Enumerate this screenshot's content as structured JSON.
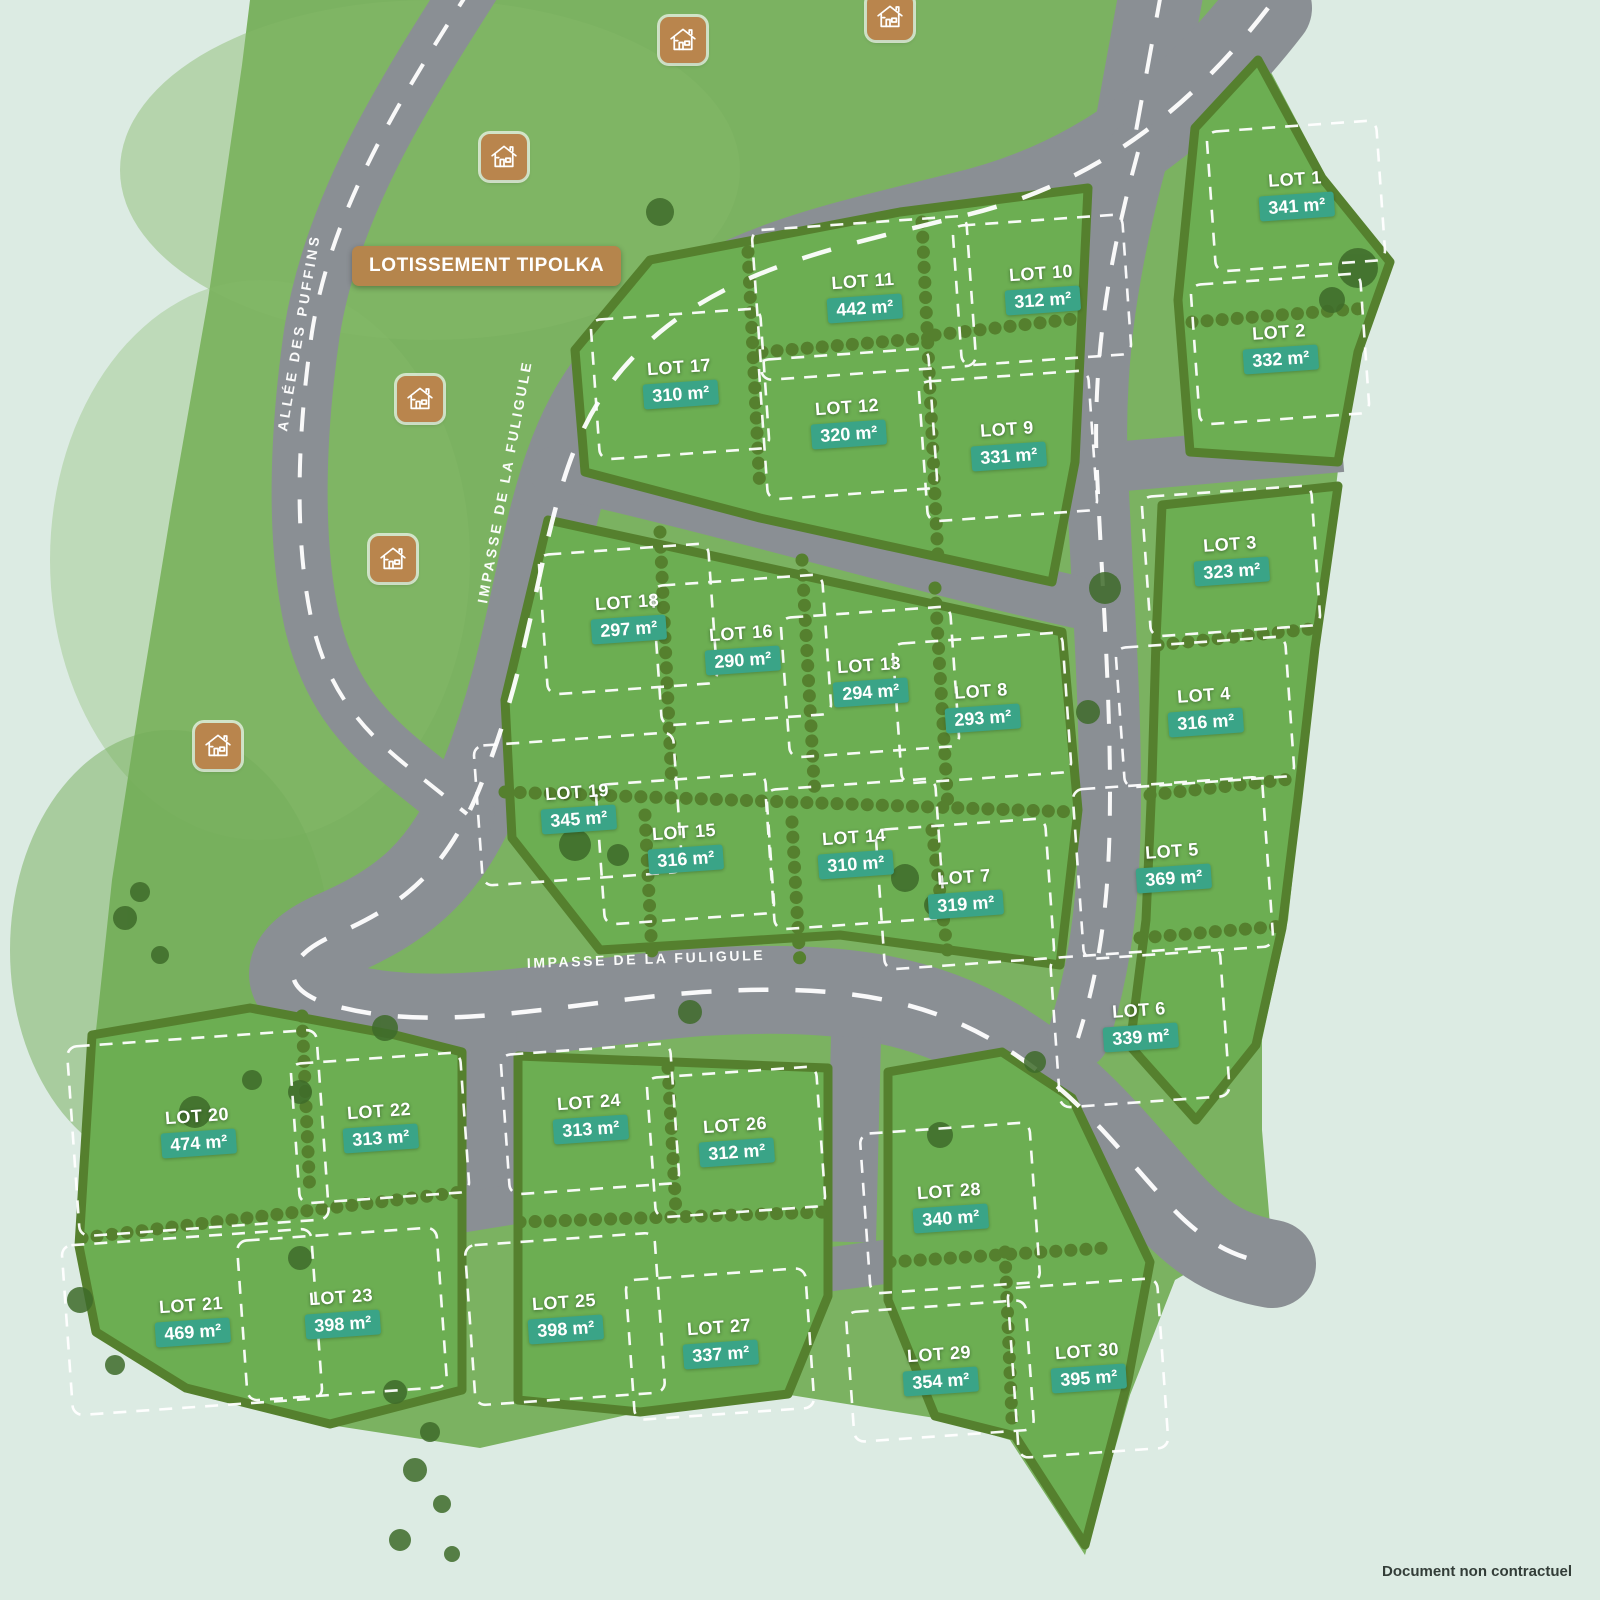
{
  "map": {
    "title_banner": "LOTISSEMENT TIPOLKA",
    "footer_note": "Document non contractuel",
    "area_unit": "m²",
    "streets": {
      "allee_des_puffins": "ALLÉE DES PUFFINS",
      "impasse_de_la_fuligule": "IMPASSE DE LA FULIGULE",
      "impasse_de_la_fuligule_2": "IMPASSE DE LA FULIGULE"
    },
    "colors": {
      "background": "#dcebe3",
      "field_grass": "#7bb261",
      "lot_grass": "#6cae52",
      "hedge": "#55802e",
      "road": "#8a8f94",
      "road_line": "#ffffff",
      "plot_outline": "#ffffff",
      "badge": "#3aa487",
      "banner": "#b5854c",
      "house_icon": "#b9854d"
    },
    "lots": [
      {
        "name": "LOT 1",
        "area": "341 m²",
        "x": 1296,
        "y": 180
      },
      {
        "name": "LOT 2",
        "area": "332 m²",
        "x": 1280,
        "y": 333
      },
      {
        "name": "LOT 3",
        "area": "323 m²",
        "x": 1231,
        "y": 545
      },
      {
        "name": "LOT 4",
        "area": "316 m²",
        "x": 1205,
        "y": 696
      },
      {
        "name": "LOT 5",
        "area": "369 m²",
        "x": 1173,
        "y": 852,
        "w": 190,
        "h": 170
      },
      {
        "name": "LOT 6",
        "area": "339 m²",
        "x": 1140,
        "y": 1011,
        "h": 150
      },
      {
        "name": "LOT 7",
        "area": "319 m²",
        "x": 965,
        "y": 878
      },
      {
        "name": "LOT 8",
        "area": "293 m²",
        "x": 982,
        "y": 692
      },
      {
        "name": "LOT 9",
        "area": "331 m²",
        "x": 1008,
        "y": 430
      },
      {
        "name": "LOT 10",
        "area": "312 m²",
        "x": 1042,
        "y": 274
      },
      {
        "name": "LOT 11",
        "area": "442 m²",
        "x": 864,
        "y": 282,
        "w": 215,
        "h": 150
      },
      {
        "name": "LOT 12",
        "area": "320 m²",
        "x": 848,
        "y": 408
      },
      {
        "name": "LOT 13",
        "area": "294 m²",
        "x": 870,
        "y": 666
      },
      {
        "name": "LOT 14",
        "area": "310 m²",
        "x": 855,
        "y": 838
      },
      {
        "name": "LOT 15",
        "area": "316 m²",
        "x": 685,
        "y": 833
      },
      {
        "name": "LOT 16",
        "area": "290 m²",
        "x": 742,
        "y": 634
      },
      {
        "name": "LOT 17",
        "area": "310 m²",
        "x": 680,
        "y": 368
      },
      {
        "name": "LOT 18",
        "area": "297 m²",
        "x": 628,
        "y": 603
      },
      {
        "name": "LOT 19",
        "area": "345 m²",
        "x": 578,
        "y": 793,
        "w": 200
      },
      {
        "name": "LOT 20",
        "area": "474 m²",
        "x": 198,
        "y": 1117,
        "w": 250,
        "h": 190
      },
      {
        "name": "LOT 21",
        "area": "469 m²",
        "x": 192,
        "y": 1306,
        "w": 250,
        "h": 170
      },
      {
        "name": "LOT 22",
        "area": "313 m²",
        "x": 380,
        "y": 1112
      },
      {
        "name": "LOT 23",
        "area": "398 m²",
        "x": 342,
        "y": 1298,
        "w": 200,
        "h": 160
      },
      {
        "name": "LOT 24",
        "area": "313 m²",
        "x": 590,
        "y": 1103
      },
      {
        "name": "LOT 25",
        "area": "398 m²",
        "x": 565,
        "y": 1303,
        "w": 190,
        "h": 160
      },
      {
        "name": "LOT 26",
        "area": "312 m²",
        "x": 736,
        "y": 1126
      },
      {
        "name": "LOT 27",
        "area": "337 m²",
        "x": 720,
        "y": 1328,
        "w": 180
      },
      {
        "name": "LOT 28",
        "area": "340 m²",
        "x": 950,
        "y": 1192,
        "h": 160
      },
      {
        "name": "LOT 29",
        "area": "354 m²",
        "x": 940,
        "y": 1355,
        "w": 180,
        "h": 130
      },
      {
        "name": "LOT 30",
        "area": "395 m²",
        "x": 1088,
        "y": 1352,
        "w": 150,
        "h": 170
      }
    ],
    "houses": [
      {
        "x": 683,
        "y": 40
      },
      {
        "x": 890,
        "y": 17
      },
      {
        "x": 504,
        "y": 157
      },
      {
        "x": 420,
        "y": 399
      },
      {
        "x": 393,
        "y": 559
      },
      {
        "x": 218,
        "y": 746
      }
    ]
  }
}
